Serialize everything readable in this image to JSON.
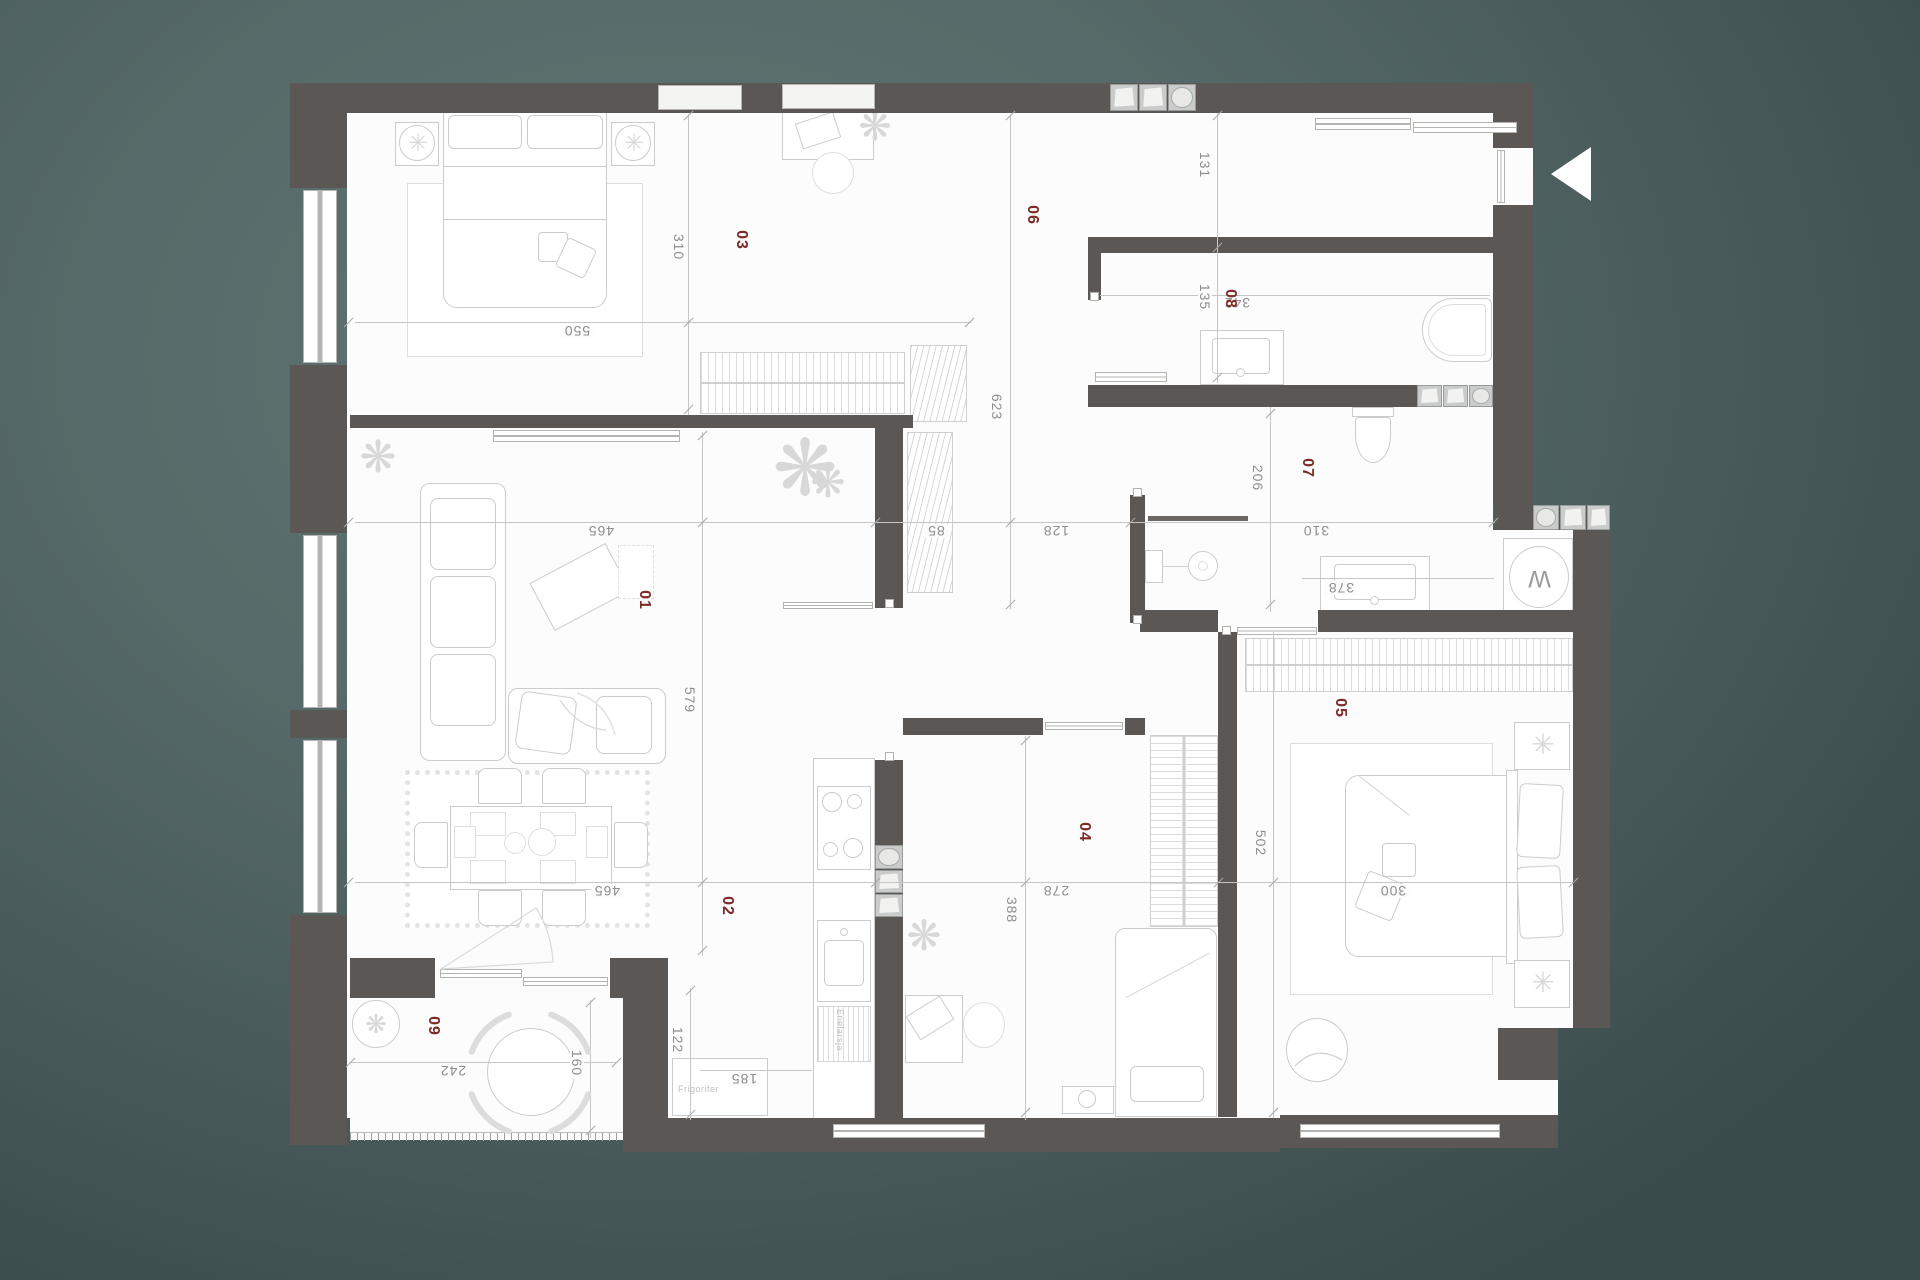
{
  "meta": {
    "type": "apartment-floor-plan",
    "colors": {
      "background_teal": "#566a69",
      "wall": "#5b5755",
      "paper": "#fcfcfc",
      "room_label": "#7c2b26",
      "dimension_text": "#8e8e8e"
    }
  },
  "rooms": {
    "r1": "01",
    "r2": "02",
    "r3": "03",
    "r4": "04",
    "r5": "05",
    "r6": "06",
    "r7": "07",
    "r8": "08",
    "r9": "09"
  },
  "dims": {
    "bedroom3_width": "310",
    "bedroom3_length": "550",
    "hall_length": "623",
    "entry_width": "131",
    "bath8_width": "135",
    "bath8_length": "342",
    "living_width": "465",
    "closet_depth": "85",
    "hall_width": "128",
    "bath7_width": "206",
    "bath7_length": "310",
    "bath7_counter": "378",
    "living_length": "579",
    "dining_width": "465",
    "bedroom4_width": "278",
    "bedroom4_length": "388",
    "bedroom5_width": "300",
    "bedroom5_length": "502",
    "kitchen_width": "122",
    "kitchen_counter": "185",
    "balcony_width": "242",
    "balcony_depth": "160"
  },
  "labels": {
    "fridge": "Frigorifer",
    "dishwasher": "Enëlarsja",
    "washer": "W"
  }
}
